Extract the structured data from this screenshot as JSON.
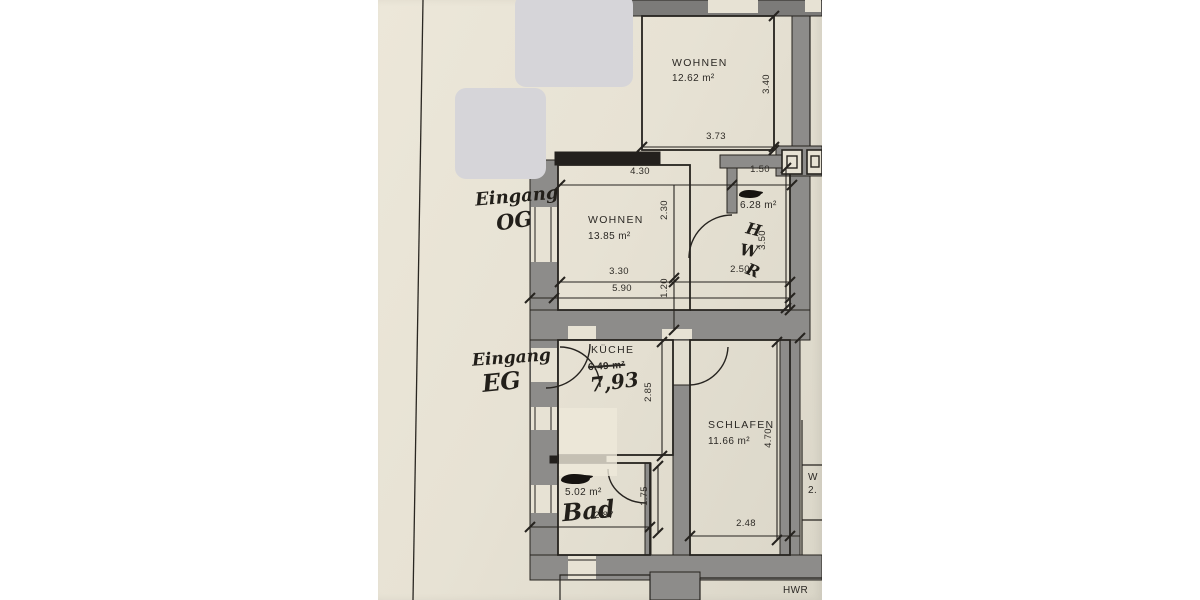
{
  "photo": {
    "description": "Photographed architectural floor plan sheet",
    "paper_color": "#e7e2d4",
    "wall_color": "#8d8c8a",
    "line_color": "#26231f",
    "sticker_color": "#d6d5d9"
  },
  "rooms": {
    "wohnen_top": {
      "name": "WOHNEN",
      "area": "12.62 m²"
    },
    "wohnen_og": {
      "name": "WOHNEN",
      "area": "13.85 m²"
    },
    "hwr_og": {
      "area": "6.28 m²",
      "letters": [
        "H",
        "W",
        "R"
      ]
    },
    "kueche": {
      "name": "KÜCHE",
      "printed_area": "6.49 m²",
      "handwritten_area": "7,93"
    },
    "schlafen": {
      "name": "SCHLAFEN",
      "area": "11.66 m²"
    },
    "bad": {
      "area": "5.02 m²",
      "handwritten_name": "Bad"
    },
    "hwr_eg": {
      "name": "HWR"
    },
    "right_partial": {
      "line1": "W",
      "line2": "2."
    }
  },
  "handwritten": {
    "eingang_og": {
      "line1": "Eingang",
      "line2": "OG"
    },
    "eingang_eg": {
      "line1": "Eingang",
      "line2": "EG"
    }
  },
  "dimensions": {
    "d373": "3.73",
    "d340": "3.40",
    "d430": "4.30",
    "d150": "1.50",
    "d230": "2.30",
    "d330": "3.30",
    "d590": "5.90",
    "d120": "1.20",
    "d250": "2.50",
    "d350": "3.50",
    "d285": "2.85",
    "d470": "4.70",
    "d175": "1.75",
    "d287": "2.87",
    "d248": "2.48"
  }
}
